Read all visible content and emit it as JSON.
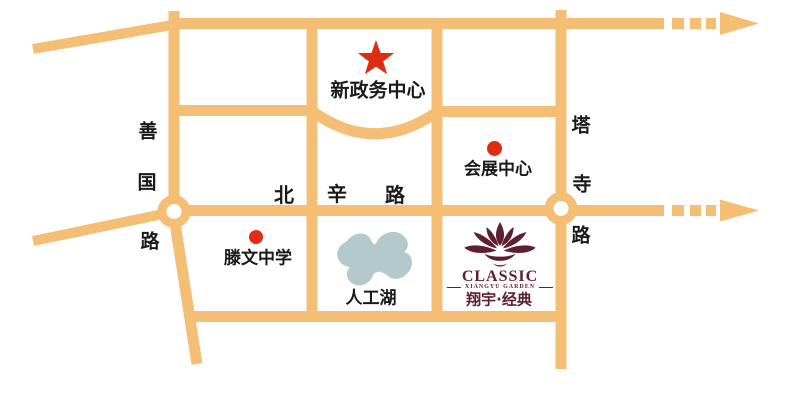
{
  "colors": {
    "road": "#F4BE74",
    "marker_red": "#DD2D12",
    "lake": "#B3C9CB",
    "logo_maroon": "#5E2030",
    "label_text": "#1A1A1A"
  },
  "landmarks": {
    "new_government_center": {
      "label": "新政务中心",
      "marker": "red-star"
    },
    "convention_center": {
      "label": "会展中心",
      "marker": "red-dot"
    },
    "tengwen_middle_school": {
      "label": "滕文中学",
      "marker": "red-dot"
    },
    "artificial_lake": {
      "label": "人工湖",
      "marker": "lake-shape"
    }
  },
  "roads": {
    "shanguo_road": {
      "name": "善国路",
      "orientation": "vertical",
      "chars": [
        "善",
        "国",
        "路"
      ]
    },
    "beixin_road": {
      "name": "北辛路",
      "orientation": "horizontal",
      "chars": [
        "北",
        "辛",
        "路"
      ]
    },
    "tasi_road": {
      "name": "塔寺路",
      "orientation": "vertical",
      "chars": [
        "塔",
        "寺",
        "路"
      ]
    }
  },
  "logo": {
    "brand_en": "CLASSIC",
    "brand_sub_en": "XIANGYU GARDEN",
    "brand_cn": "翔宇·经典"
  }
}
